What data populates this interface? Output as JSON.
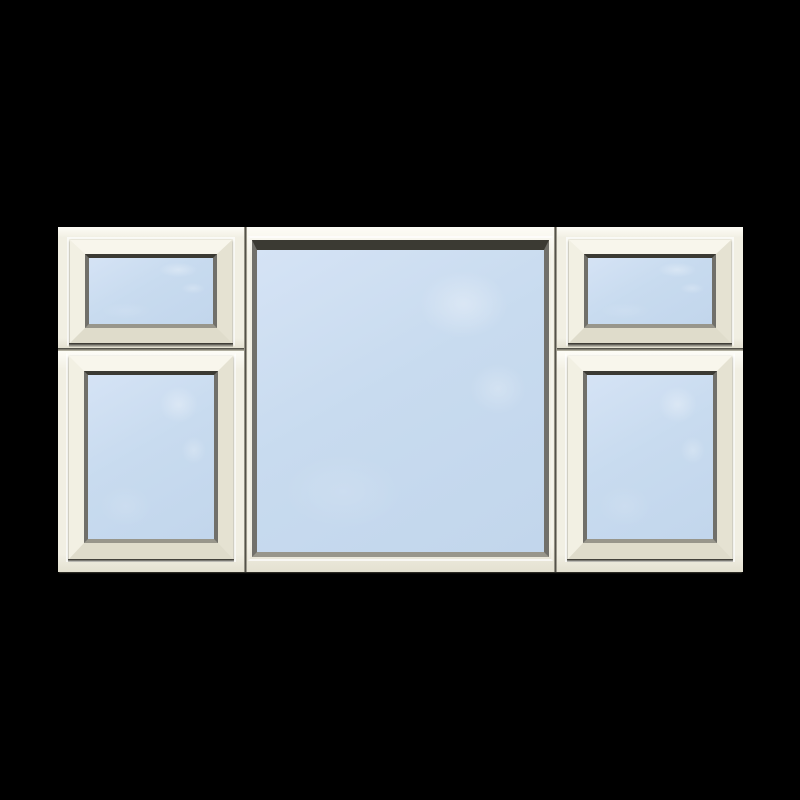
{
  "image": {
    "type": "product-render",
    "subject": "Cream uPVC combination window with five panes on a black background: left and right columns each have a small top-hung vent above a larger casement, with one large fixed pane in the centre",
    "background_color": "#000000"
  },
  "window": {
    "pane_count": 5,
    "layout": {
      "columns": [
        "left-casement-pair",
        "centre-fixed",
        "right-casement-pair"
      ],
      "left_column_panes": [
        "top-vent",
        "bottom-casement"
      ],
      "centre_column_panes": [
        "fixed-pane"
      ],
      "right_column_panes": [
        "top-vent",
        "bottom-casement"
      ]
    },
    "colors": {
      "frame": "#f1efe3",
      "frame_highlight": "#fdfcf6",
      "frame_shade": "#e4e1d1",
      "frame_edge": "#d8d5c4",
      "sash_top": "#f8f6ec",
      "sash_left": "#f2f0e3",
      "sash_right": "#e5e2d2",
      "sash_bottom": "#dfdccb",
      "bead_dark": "#3b3a33",
      "bead_mid": "#71706a",
      "bead_light": "#98968b",
      "glass": "#c8dbef",
      "glass_light": "#d5e3f5",
      "glass_deep": "#c2d6ec",
      "seam_dark": "#3e3d36",
      "seam_light": "#c6c3b3",
      "under_shadow": "rgba(34,33,28,0.9)"
    }
  }
}
